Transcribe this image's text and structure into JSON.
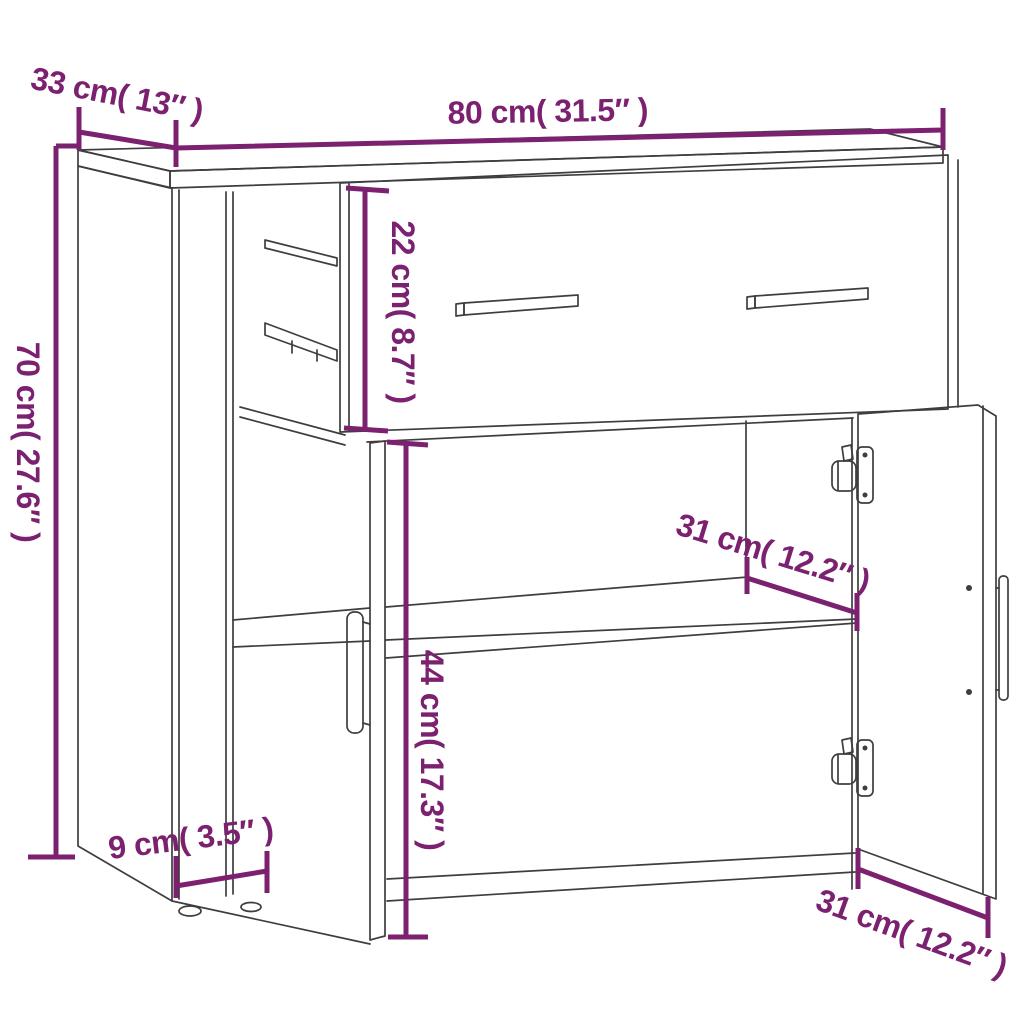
{
  "colors": {
    "accent": "#7b2170",
    "line": "#3e3e3e",
    "background": "#ffffff"
  },
  "dimensions": {
    "width": {
      "label": "80 cm( 31.5″ )",
      "cm": 80,
      "inches": 31.5
    },
    "depth": {
      "label": "33 cm( 13″ )",
      "cm": 33,
      "inches": 13
    },
    "height": {
      "label": "70 cm( 27.6″ )",
      "cm": 70,
      "inches": 27.6
    },
    "drawer_height": {
      "label": "22 cm( 8.7″ )",
      "cm": 22,
      "inches": 8.7
    },
    "shelf_depth": {
      "label": "31 cm( 12.2″ )",
      "cm": 31,
      "inches": 12.2
    },
    "compartment_height": {
      "label": "44 cm( 17.3″ )",
      "cm": 44,
      "inches": 17.3
    },
    "plinth_height": {
      "label": "9 cm( 3.5″ )",
      "cm": 9,
      "inches": 3.5
    },
    "door_width": {
      "label": "31 cm( 12.2″ )",
      "cm": 31,
      "inches": 12.2
    }
  }
}
